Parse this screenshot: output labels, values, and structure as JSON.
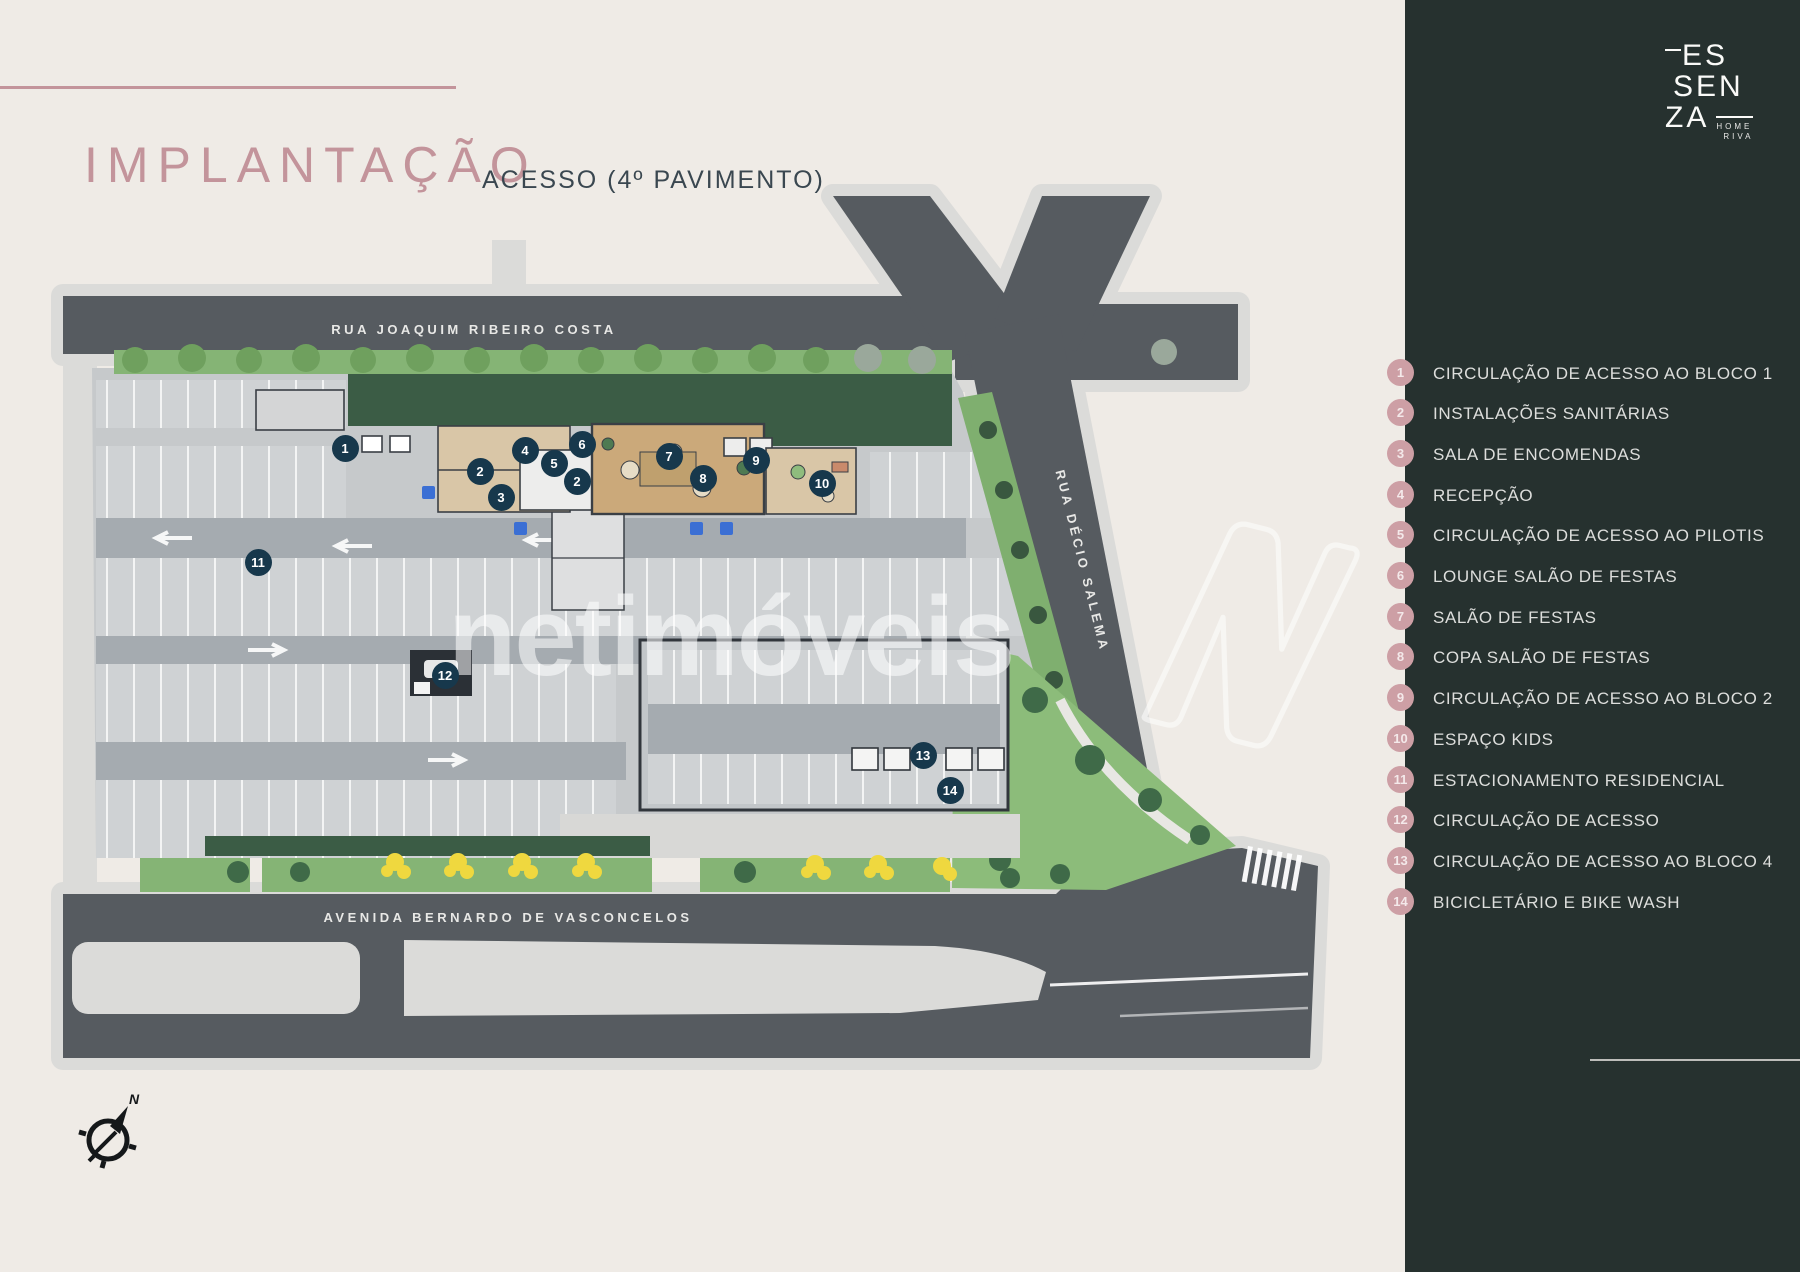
{
  "header": {
    "title": "IMPLANTAÇÃO",
    "subtitle": "ACESSO (4º PAVIMENTO)"
  },
  "logo": {
    "line1": "ES",
    "line2": "SEN",
    "line3": "ZA",
    "tagline_line1": "HOME",
    "tagline_line2": "RIVA"
  },
  "watermark": {
    "text": "netimóveis"
  },
  "plan": {
    "streets": {
      "top": "RUA JOAQUIM RIBEIRO COSTA",
      "right": "RUA DÉCIO SALEMA",
      "bottom": "AVENIDA BERNARDO DE VASCONCELOS"
    },
    "compass_label": "N",
    "markers": [
      {
        "label": "1",
        "x": 345,
        "y": 448
      },
      {
        "label": "2",
        "x": 480,
        "y": 471
      },
      {
        "label": "3",
        "x": 501,
        "y": 497
      },
      {
        "label": "4",
        "x": 525,
        "y": 450
      },
      {
        "label": "5",
        "x": 554,
        "y": 463
      },
      {
        "label": "6",
        "x": 582,
        "y": 444
      },
      {
        "label": "2",
        "x": 577,
        "y": 481
      },
      {
        "label": "7",
        "x": 669,
        "y": 456
      },
      {
        "label": "8",
        "x": 703,
        "y": 478
      },
      {
        "label": "9",
        "x": 756,
        "y": 460
      },
      {
        "label": "10",
        "x": 822,
        "y": 483
      },
      {
        "label": "11",
        "x": 258,
        "y": 562
      },
      {
        "label": "12",
        "x": 445,
        "y": 675
      },
      {
        "label": "13",
        "x": 923,
        "y": 755
      },
      {
        "label": "14",
        "x": 950,
        "y": 790
      }
    ]
  },
  "legend": {
    "items": [
      {
        "number": "1",
        "label": "CIRCULAÇÃO DE ACESSO AO BLOCO 1"
      },
      {
        "number": "2",
        "label": "INSTALAÇÕES SANITÁRIAS"
      },
      {
        "number": "3",
        "label": "SALA DE ENCOMENDAS"
      },
      {
        "number": "4",
        "label": "RECEPÇÃO"
      },
      {
        "number": "5",
        "label": "CIRCULAÇÃO DE ACESSO AO PILOTIS"
      },
      {
        "number": "6",
        "label": "LOUNGE SALÃO DE FESTAS"
      },
      {
        "number": "7",
        "label": "SALÃO DE FESTAS"
      },
      {
        "number": "8",
        "label": "COPA SALÃO DE FESTAS"
      },
      {
        "number": "9",
        "label": "CIRCULAÇÃO DE ACESSO AO BLOCO 2"
      },
      {
        "number": "10",
        "label": "ESPAÇO KIDS"
      },
      {
        "number": "11",
        "label": "ESTACIONAMENTO RESIDENCIAL"
      },
      {
        "number": "12",
        "label": "CIRCULAÇÃO DE ACESSO"
      },
      {
        "number": "13",
        "label": "CIRCULAÇÃO DE ACESSO AO BLOCO 4"
      },
      {
        "number": "14",
        "label": "BICICLETÁRIO E BIKE WASH"
      }
    ]
  },
  "colors": {
    "background": "#EFEBE6",
    "sidebar": "#26312F",
    "accent_rose": "#C3949B",
    "legend_badge": "#CD9FA5",
    "legend_text": "#DDDEDC",
    "marker": "#17384C",
    "asphalt": "#565B60",
    "deck": "#C6C9CB",
    "lawn": "#85B475",
    "roof_green": "#3B5C45",
    "amenity_tan": "#D9C6A7"
  }
}
